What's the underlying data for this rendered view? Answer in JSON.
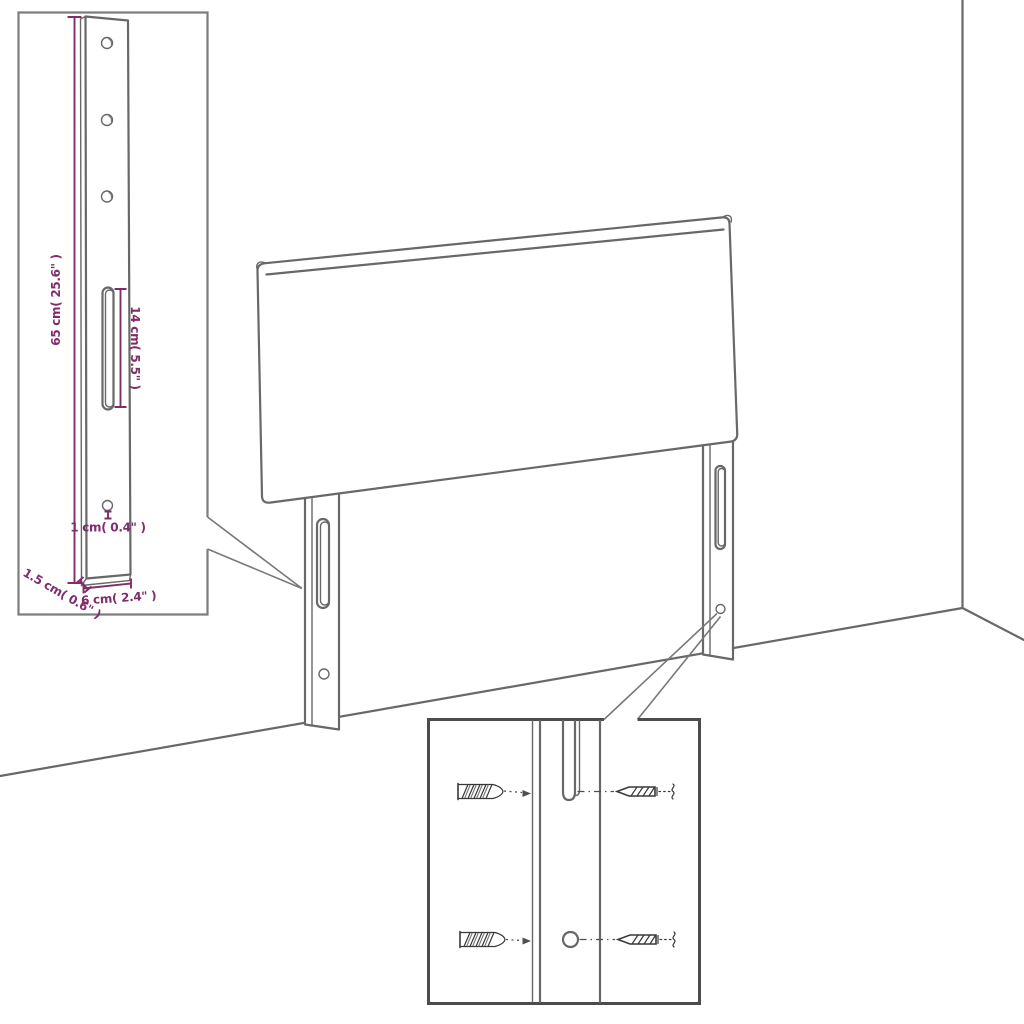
{
  "diagram": {
    "type": "furniture-assembly-dimension-diagram",
    "subject": "upholstered headboard with two slotted mounting legs in a room corner",
    "colors": {
      "background": "#ffffff",
      "line_art": "#686868",
      "dimension_accent": "#802d6b",
      "detail_inset_border": "#7d7d7d",
      "mounting_inset_border": "#4c4c4c"
    },
    "leg_detail_inset": {
      "description": "enlarged side view of one mounting leg with dimensions",
      "dim_height": "65 cm( 25.6\" )",
      "dim_slot": "14 cm( 5.5\" )",
      "dim_hole": "1 cm( 0.4\" )",
      "dim_thickness": "1.5 cm( 0.6\" )",
      "dim_width": "6 cm( 2.4\" )"
    },
    "mounting_detail_inset": {
      "description": "close-up of leg slot and hole with wall plugs and screws",
      "icons": {
        "wall_plug_top": "wall-plug-icon",
        "wall_plug_bottom": "wall-plug-icon",
        "screw_top": "screw-icon",
        "screw_bottom": "screw-icon"
      }
    }
  }
}
